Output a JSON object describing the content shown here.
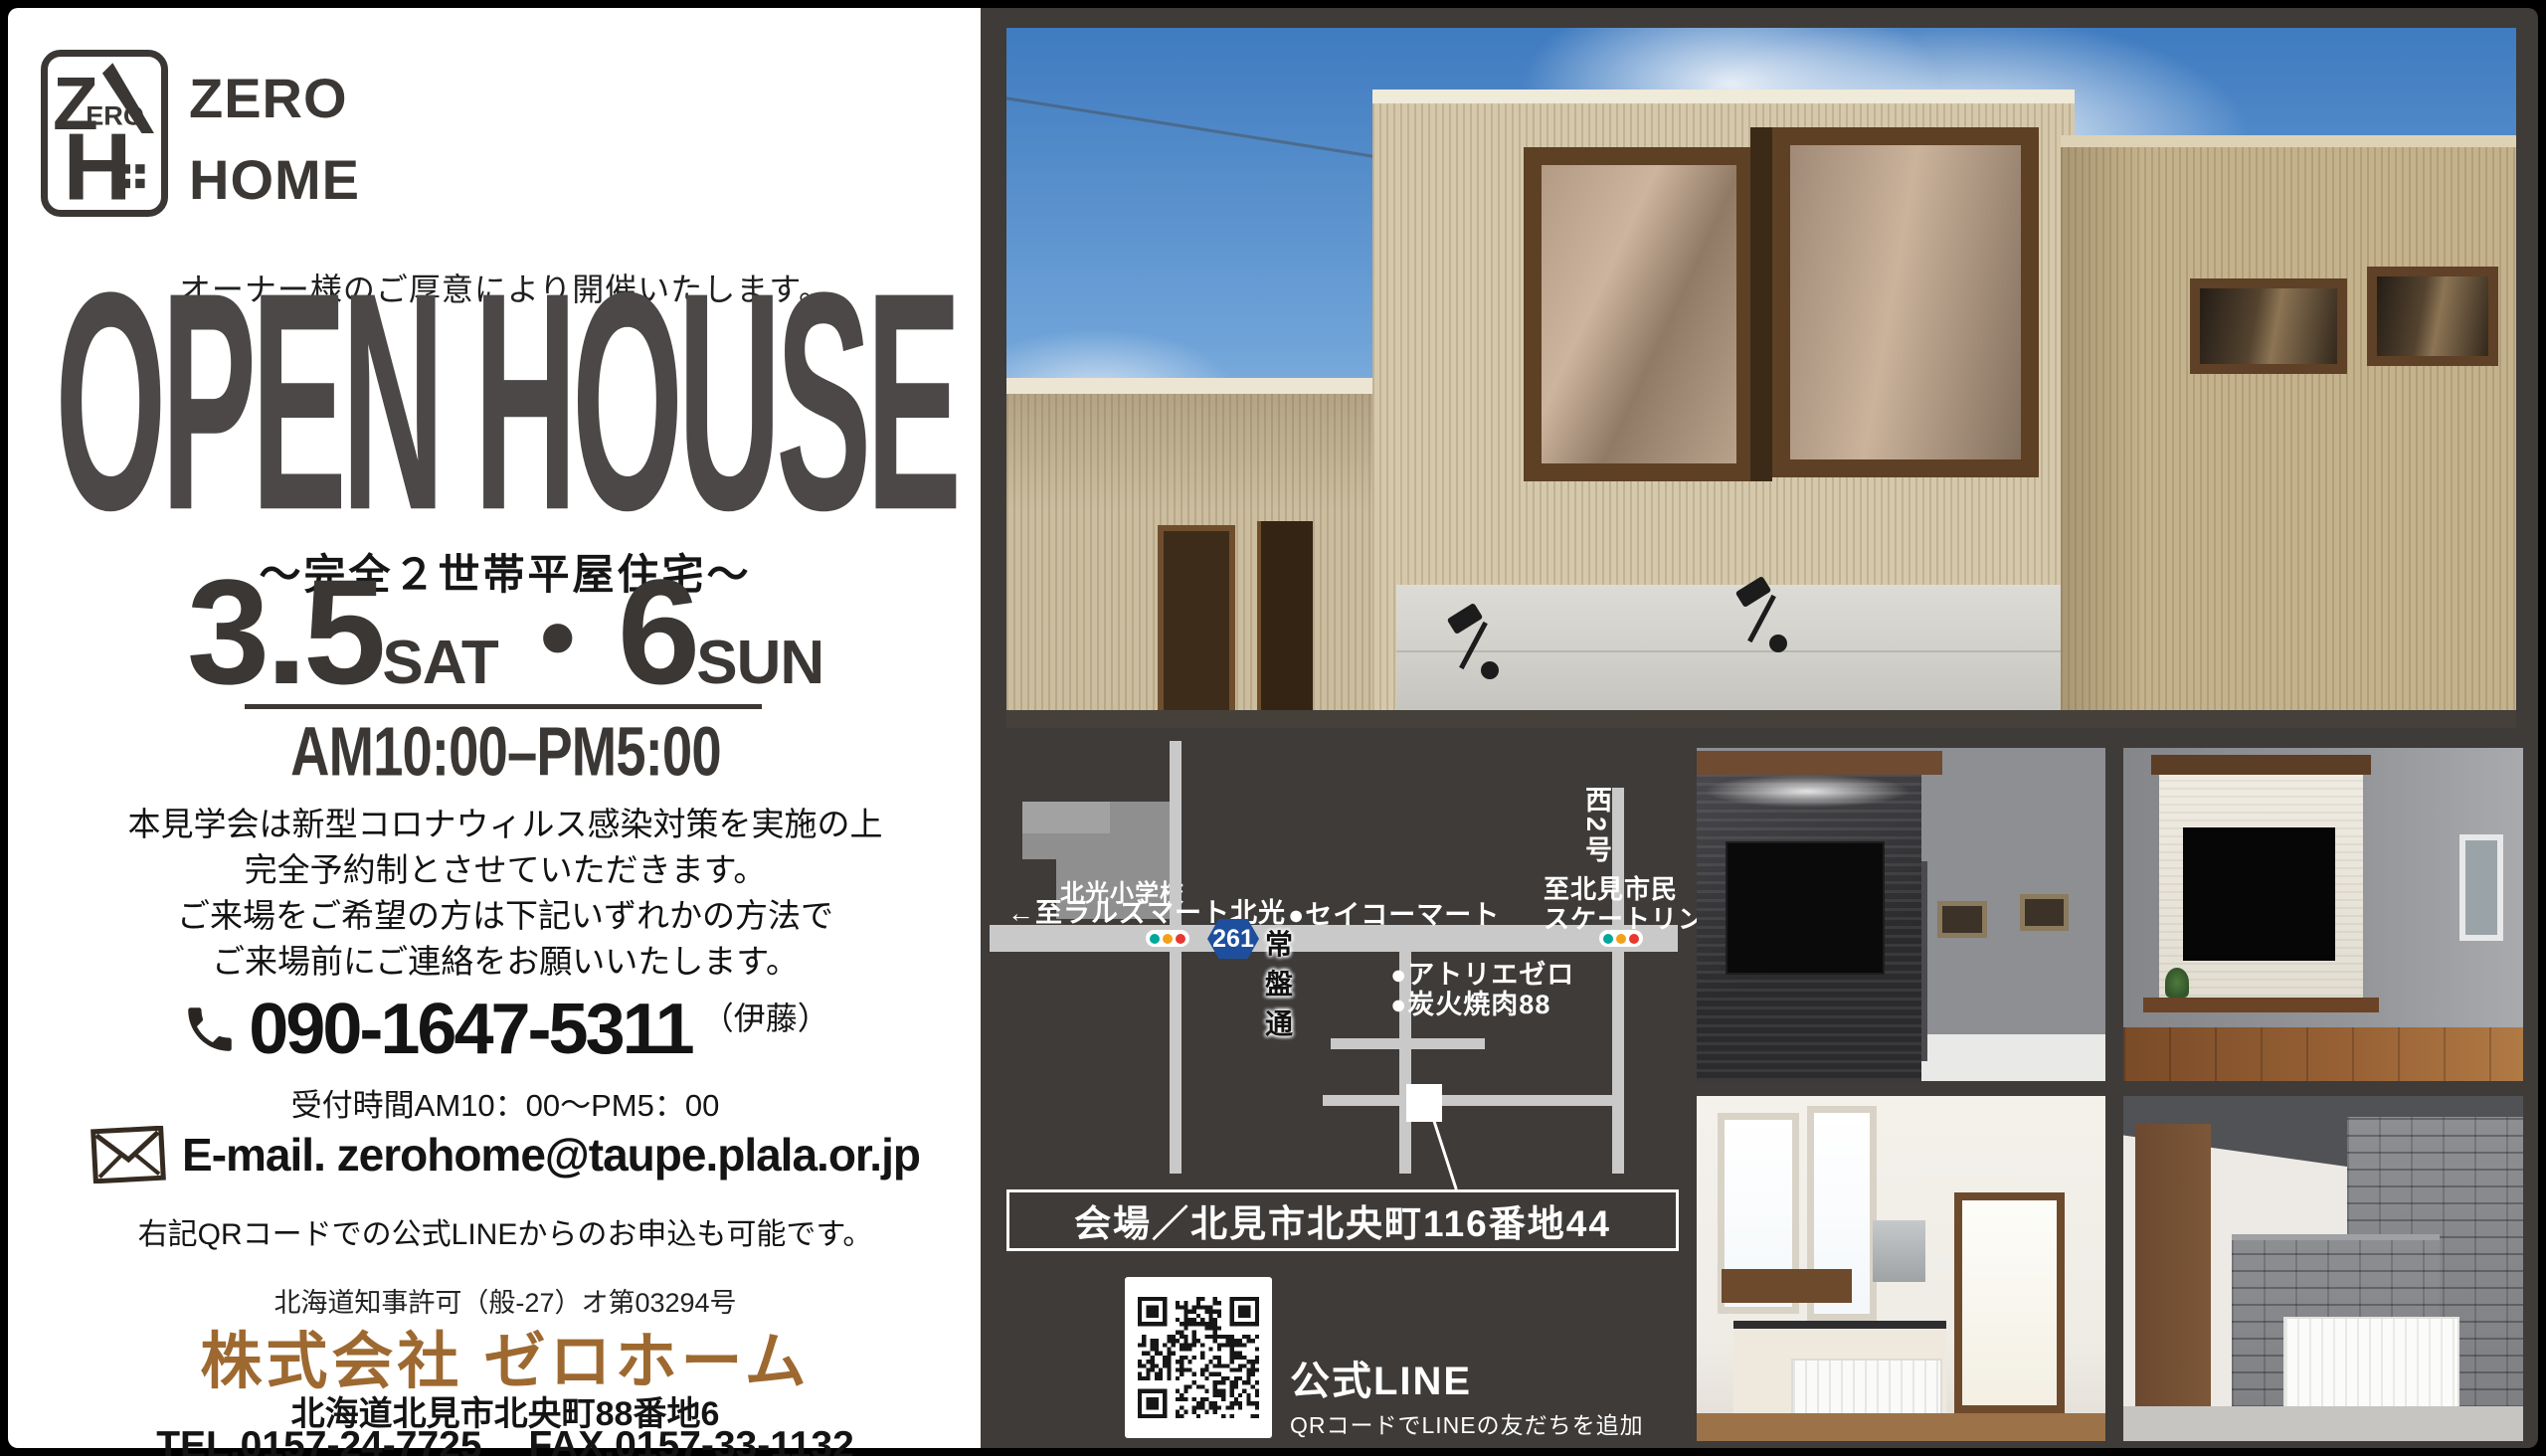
{
  "flyer": {
    "brand": {
      "mark_letter_z": "Z",
      "mark_letters_ero": "ERO",
      "mark_letter_h": "H",
      "name_line1": "ZERO",
      "name_line2": "HOME"
    },
    "hero": {
      "notice": "オーナー様のご厚意により開催いたします。",
      "title": "OPEN HOUSE",
      "subtitle": "～完全２世帯平屋住宅～"
    },
    "schedule": {
      "date1": "3.5",
      "date1_day": "SAT",
      "separator": "・",
      "date2": "6",
      "date2_day": "SUN",
      "time": "AM10:00–PM5:00"
    },
    "covid_notice": {
      "line1": "本見学会は新型コロナウィルス感染対策を実施の上",
      "line2": "完全予約制とさせていただきます。",
      "line3": "ご来場をご希望の方は下記いずれかの方法で",
      "line4": "ご来場前にご連絡をお願いいたします。"
    },
    "contact": {
      "phone": "090-1647-5311",
      "phone_contact": "（伊藤）",
      "hours": "受付時間AM10：00～PM5：00",
      "email": "E-mail. zerohome@taupe.plala.or.jp",
      "qr_note": "右記QRコードでの公式LINEからのお申込も可能です。"
    },
    "company": {
      "license": "北海道知事許可（般-27）オ第03294号",
      "name": "株式会社 ゼロホーム",
      "address": "北海道北見市北央町88番地6",
      "tel": "TEL.0157-24-7725",
      "fax": "FAX.0157-33-1132"
    },
    "map": {
      "school": "北光小学校",
      "west_destination": "←至ラルズマート北光",
      "store": "●セイコーマート",
      "route_number": "261",
      "route_name": "常盤通",
      "poi1": "●アトリエゼロ",
      "poi2": "●炭火焼肉88",
      "east_road": "西2号",
      "east_destination_line1": "至北見市民",
      "east_destination_line2": "スケートリンク→",
      "venue": "会場／北見市北央町116番地44"
    },
    "line_section": {
      "title": "公式LINE",
      "caption": "QRコードでLINEの友だちを追加"
    },
    "colors": {
      "panel_dark": "#3e3b39",
      "accent_brown": "#9d6930",
      "title_gray": "#4b4847",
      "road_gray": "#c9c9c9",
      "route_badge_blue": "#1d4f9e",
      "signal_green": "#00a79b",
      "signal_yellow": "#f3a11a",
      "signal_red": "#e8382f"
    }
  }
}
